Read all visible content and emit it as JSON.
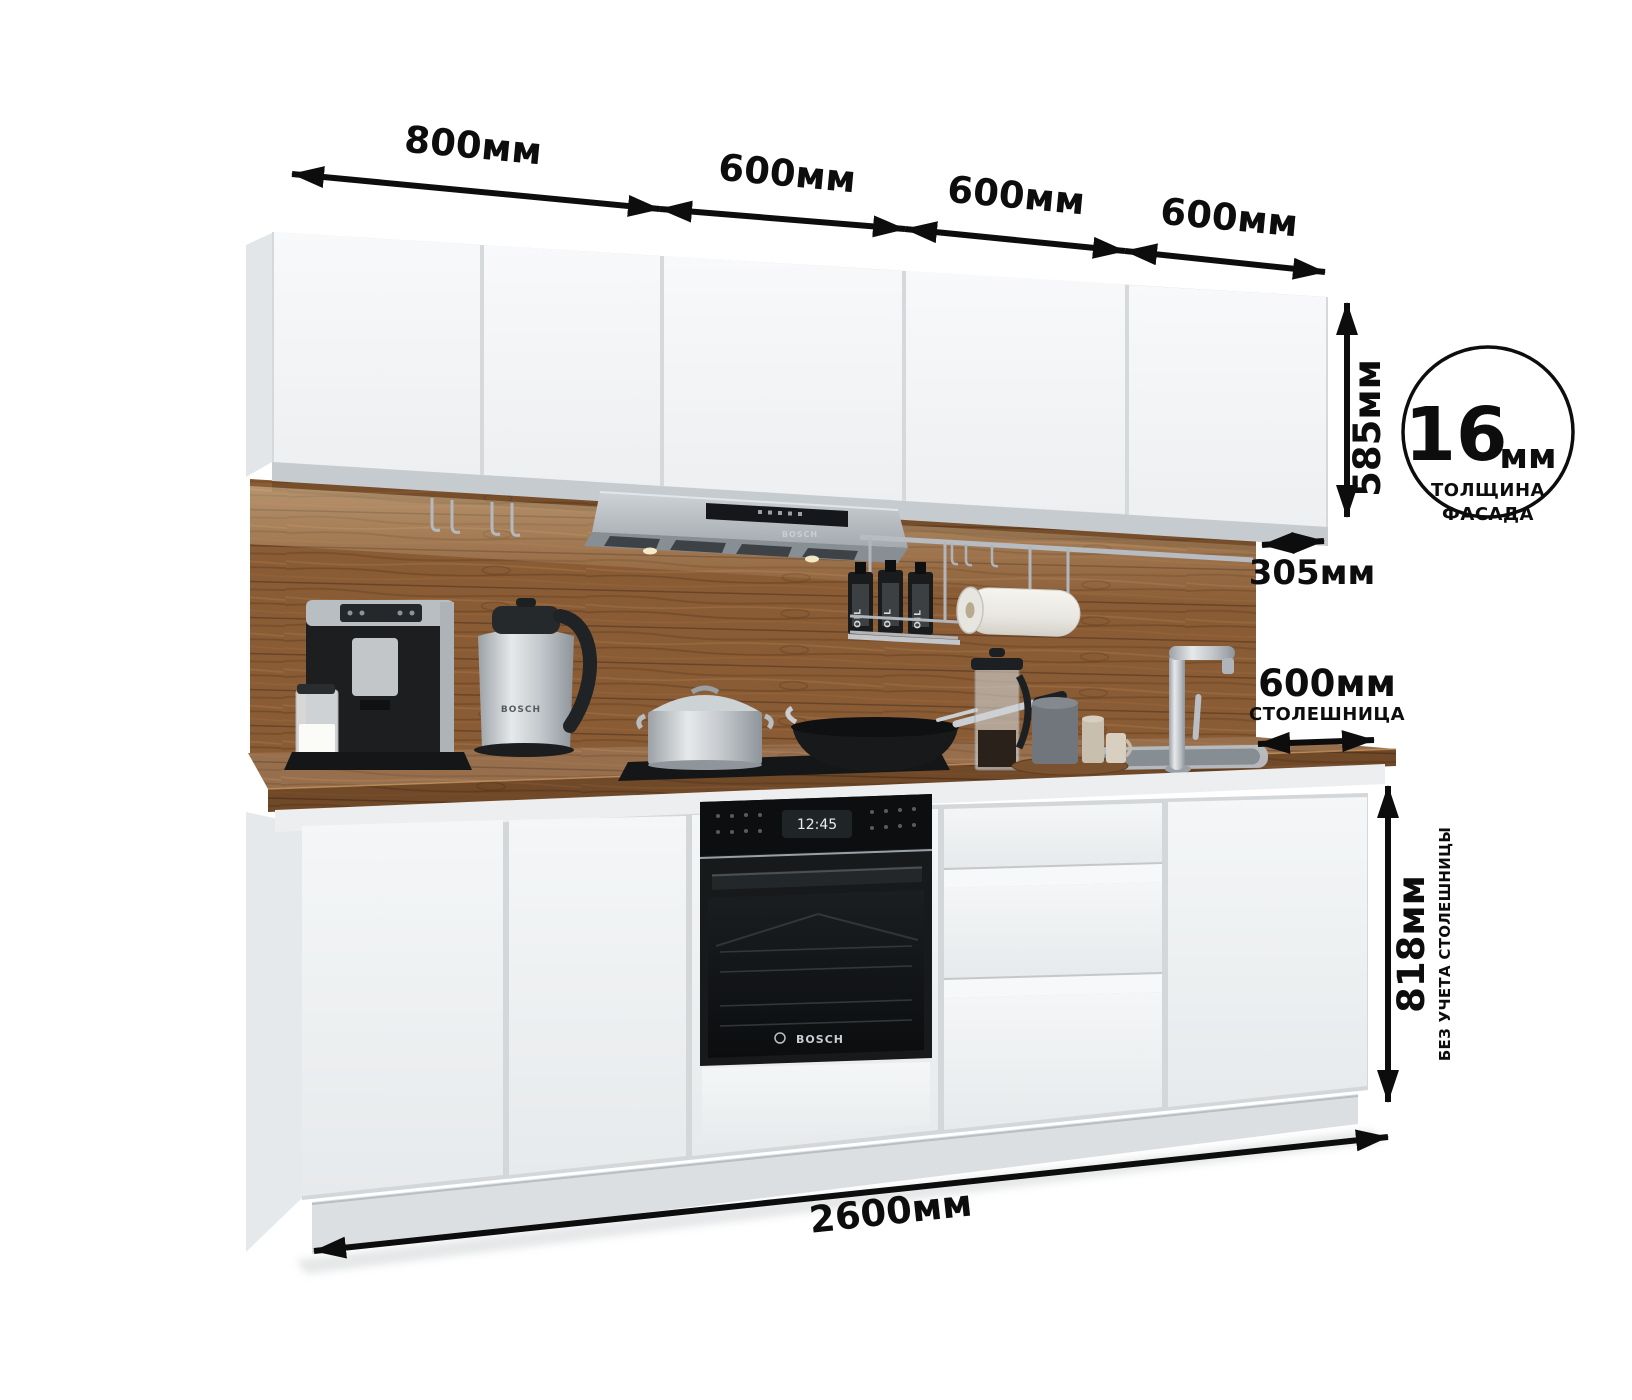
{
  "page": {
    "background": "#ffffff"
  },
  "dimensions": {
    "arrow_color": "#0d0d0d",
    "top_widths": [
      {
        "label": "800мм"
      },
      {
        "label": "600мм"
      },
      {
        "label": "600мм"
      },
      {
        "label": "600мм"
      }
    ],
    "upper_cabinet_height": {
      "label": "585мм"
    },
    "upper_cabinet_depth": {
      "label": "305мм"
    },
    "facade_thickness_badge": {
      "value": "16",
      "unit": "мм",
      "caption_line1": "ТОЛЩИНА",
      "caption_line2": "ФАСАДА"
    },
    "countertop_depth": {
      "label": "600мм",
      "caption": "СТОЛЕШНИЦА"
    },
    "base_height": {
      "label": "818мм",
      "caption": "БЕЗ УЧЕТА СТОЛЕШНИЦЫ"
    },
    "total_width": {
      "label": "2600мм"
    }
  },
  "scene": {
    "colors": {
      "cabinet_white": "#f3f5f6",
      "wood": "#8a5c35",
      "wood_dark": "#5f3d1e",
      "steel": "#b9bfc4",
      "appliance_black": "#17191b"
    },
    "hood": {
      "brand": "BOSCH"
    },
    "oven": {
      "brand": "BOSCH",
      "display_time": "12:45"
    },
    "kettle": {
      "brand": "BOSCH"
    },
    "oil_bottles": {
      "label": "OIL"
    }
  }
}
